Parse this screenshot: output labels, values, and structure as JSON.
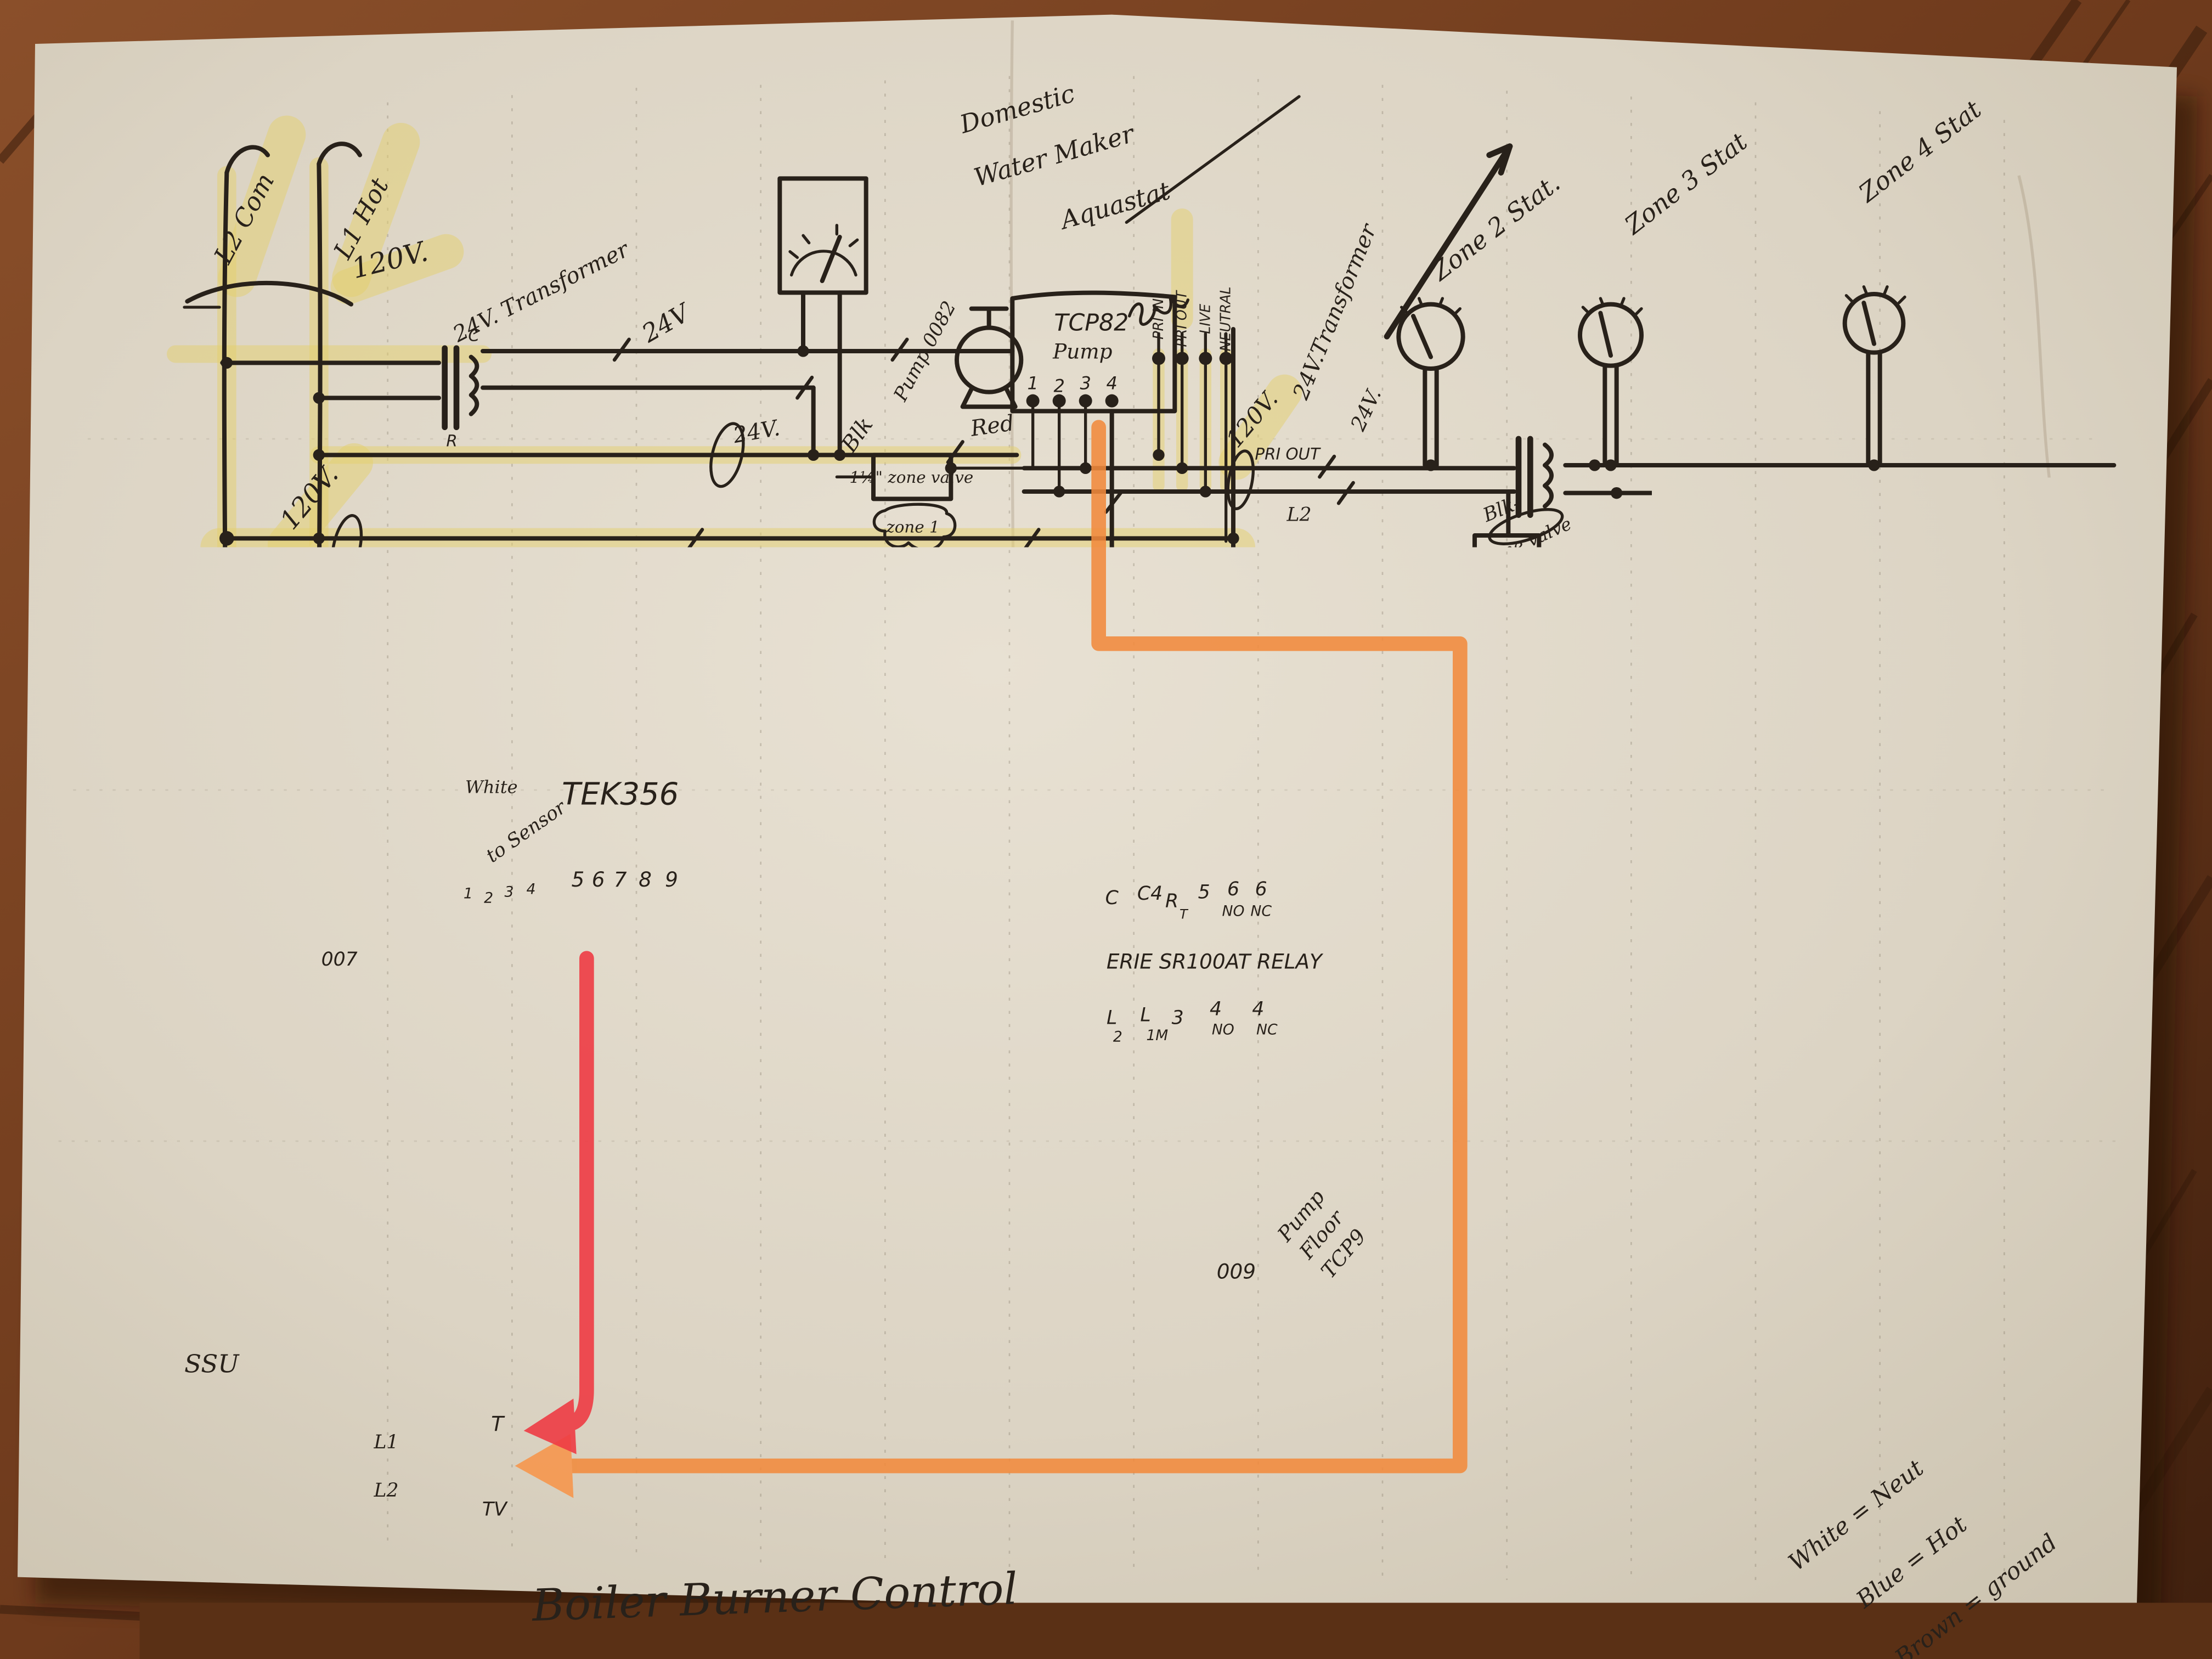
{
  "colors": {
    "paper": "#dcd4c4",
    "ink": "#28211a",
    "highlighter": "#e4cf6e",
    "marker_orange": "#f18a3c",
    "marker_red": "#ee3b44",
    "wood": "#7c4524"
  },
  "title": {
    "caption": "Boiler Burner Control"
  },
  "mains": {
    "l2": "L2 Com",
    "l1": "L1 Hot",
    "v120": "120V."
  },
  "transformer_left": {
    "label": "24V. Transformer",
    "c": "C",
    "r": "R",
    "v24": "24V",
    "v24_bus": "24V."
  },
  "aquastat": {
    "line1": "Domestic",
    "line2": "Water Maker",
    "line3": "Aquastat",
    "terminals": [
      "PRI IN",
      "PRI OUT",
      "LIVE",
      "NEUTRAL"
    ]
  },
  "pump82": {
    "label": "Pump 0082",
    "box_title": "TCP82",
    "box_sub": "Pump",
    "terminals": [
      "1",
      "2",
      "3",
      "4"
    ],
    "red": "Red",
    "blk": "Blk"
  },
  "valve1": {
    "label": "1¼\" zone valve",
    "zone": "zone 1"
  },
  "transformer_right": {
    "label": "24V.Transformer",
    "v120": "120V.",
    "pri_out": "PRI OUT",
    "l2": "L2",
    "v24": "24V."
  },
  "stats": {
    "zone2": "Zone 2 Stat.",
    "zone3": "Zone 3 Stat",
    "zone4": "Zone 4 Stat"
  },
  "valves": {
    "zone2": {
      "blk": "Blk-",
      "script": "zone valve",
      "zone": "zone 2",
      "red": "Red"
    },
    "zone3": {
      "blk": "Blk",
      "zone": "zone 3",
      "red": "Red"
    },
    "zone4": {
      "blk": "Blk",
      "zone": "zone 4",
      "red": "Red"
    }
  },
  "left": {
    "v120_a": "120V.",
    "grd": "Grd.",
    "v120_b": "120V.",
    "v120_c": "120V.",
    "tcp7_1": "TCP7",
    "tcp7_2": "Circulating",
    "tcp7_3": "Pump",
    "pump007": "007"
  },
  "tek356": {
    "title": "TEK356",
    "white": "White",
    "to_sensor": "to Sensor",
    "terminals_left": [
      "1",
      "2",
      "3",
      "4"
    ],
    "terminals_right": [
      "5",
      "6",
      "7",
      "8",
      "9"
    ]
  },
  "relay": {
    "title": "ERIE SR100AT RELAY",
    "top": [
      "C",
      "C4",
      "R",
      "5",
      "6",
      "6"
    ],
    "top_sub": [
      "",
      "",
      "T",
      "",
      "NO",
      "NC"
    ],
    "bottom": [
      "L",
      "L",
      "3",
      "4",
      "4"
    ],
    "bottom_sub": [
      "2",
      "1M",
      "",
      "NO",
      "NC"
    ]
  },
  "pump9": {
    "label1": "Pump",
    "label2": "Floor",
    "label3": "TCP9",
    "pump009": "009"
  },
  "bottom": {
    "ssu": "SSU",
    "l1": "L1",
    "l2": "L2",
    "t": "T",
    "tv": "TV"
  },
  "legend": {
    "white": "White = Neut",
    "blue": "Blue = Hot",
    "brown": "Brown = ground"
  }
}
